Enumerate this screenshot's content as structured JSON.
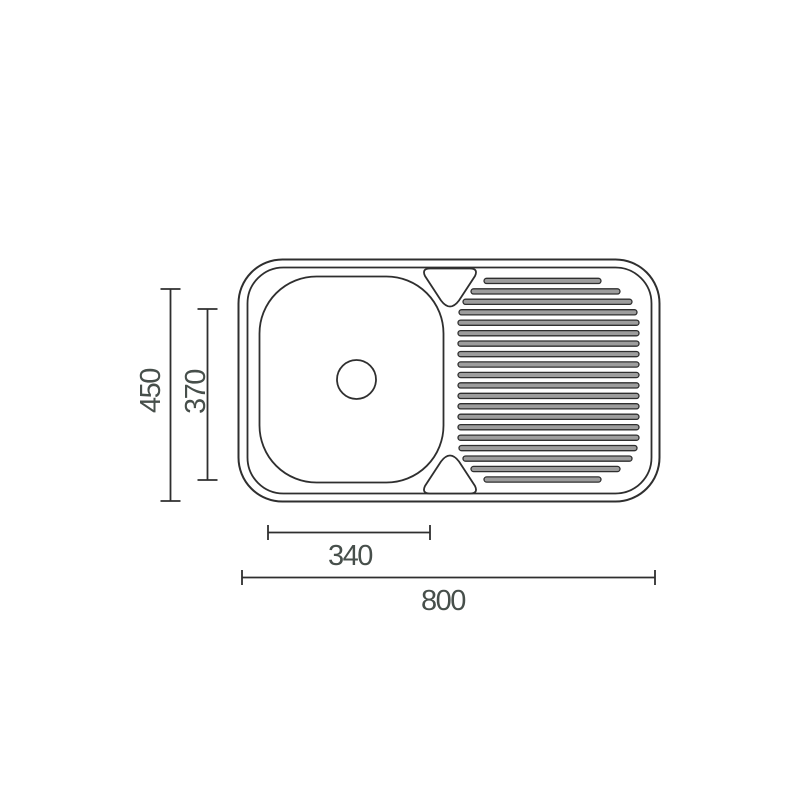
{
  "drawing": {
    "subject": "kitchen-sink-single-bowl-with-drainer-top-view",
    "labels": {
      "overall_length": "800",
      "overall_depth": "450",
      "bowl_length": "340",
      "bowl_depth": "370"
    },
    "drainer_rib_count": 20,
    "colors": {
      "background": "#ffffff",
      "line": "#2f2f2f",
      "label_text": "#474f4b",
      "rib_fill": "#9d9d9d"
    }
  }
}
